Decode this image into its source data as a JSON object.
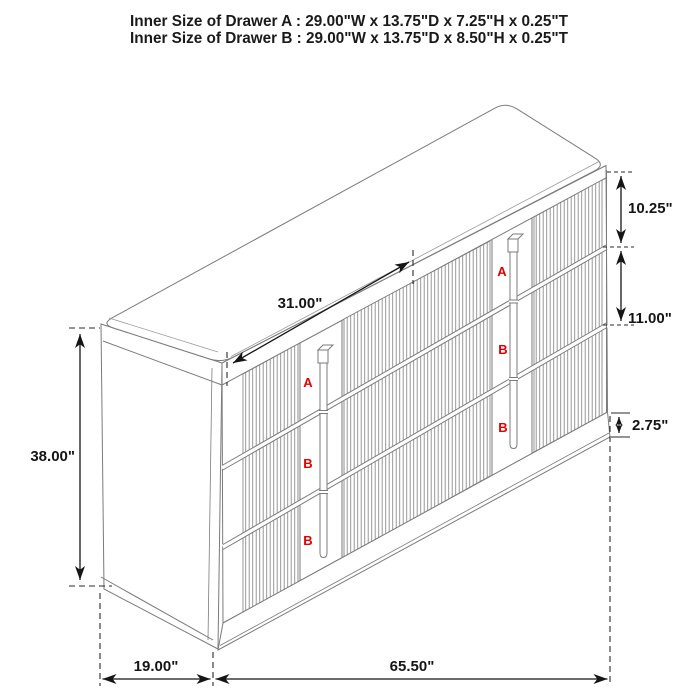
{
  "title": {
    "line1": "Inner Size of Drawer A : 29.00\"W x 13.75\"D x 7.25\"H x 0.25\"T",
    "line2": "Inner Size of Drawer B : 29.00\"W x 13.75\"D x 8.50\"H x 0.25\"T"
  },
  "dims": {
    "top_section_width": "31.00\"",
    "drawer_a_height": "10.25\"",
    "drawer_b_height": "11.00\"",
    "base_height": "2.75\"",
    "overall_height": "38.00\"",
    "depth": "19.00\"",
    "width": "65.50\""
  },
  "labels": {
    "left_column": [
      "A",
      "B",
      "B"
    ],
    "right_column": [
      "A",
      "B",
      "B"
    ]
  },
  "colors": {
    "background": "#ffffff",
    "furniture_line": "#7b7b7b",
    "flute_line": "#8d8d8d",
    "dimension_line": "#151515",
    "drawer_label_red": "#e50000"
  }
}
